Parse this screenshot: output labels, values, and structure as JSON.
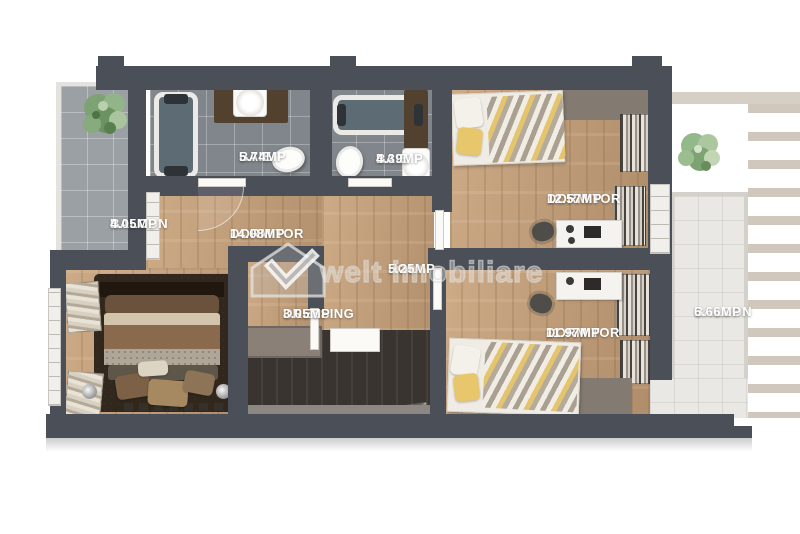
{
  "watermark": {
    "text": "welt imobiliare",
    "logo": "house-checkmark-logo"
  },
  "rooms": [
    {
      "name": "BALCON",
      "area": "4.05MP"
    },
    {
      "name": "BAIE",
      "area": "5.74MP"
    },
    {
      "name": "BAIE",
      "area": "4.39MP"
    },
    {
      "name": "DORMITOR",
      "area": "14.08MP"
    },
    {
      "name": "DORMITOR",
      "area": "12.57MP"
    },
    {
      "name": "HOL",
      "area": "5.25MP"
    },
    {
      "name": "DRESSING",
      "area": "3.05MP"
    },
    {
      "name": "DORMITOR",
      "area": "11.97MP"
    },
    {
      "name": "BALCON",
      "area": "6.66MP"
    }
  ],
  "colors": {
    "wall": "#4b4f57",
    "wood_floor": "#c09c7a",
    "bath_tile": "#80868b",
    "balcony_tile_left": "#9aa0a3",
    "balcony_tile_right": "#e9e8e4",
    "accent_yellow": "#e4c46c",
    "label_text": "#ffffff"
  }
}
